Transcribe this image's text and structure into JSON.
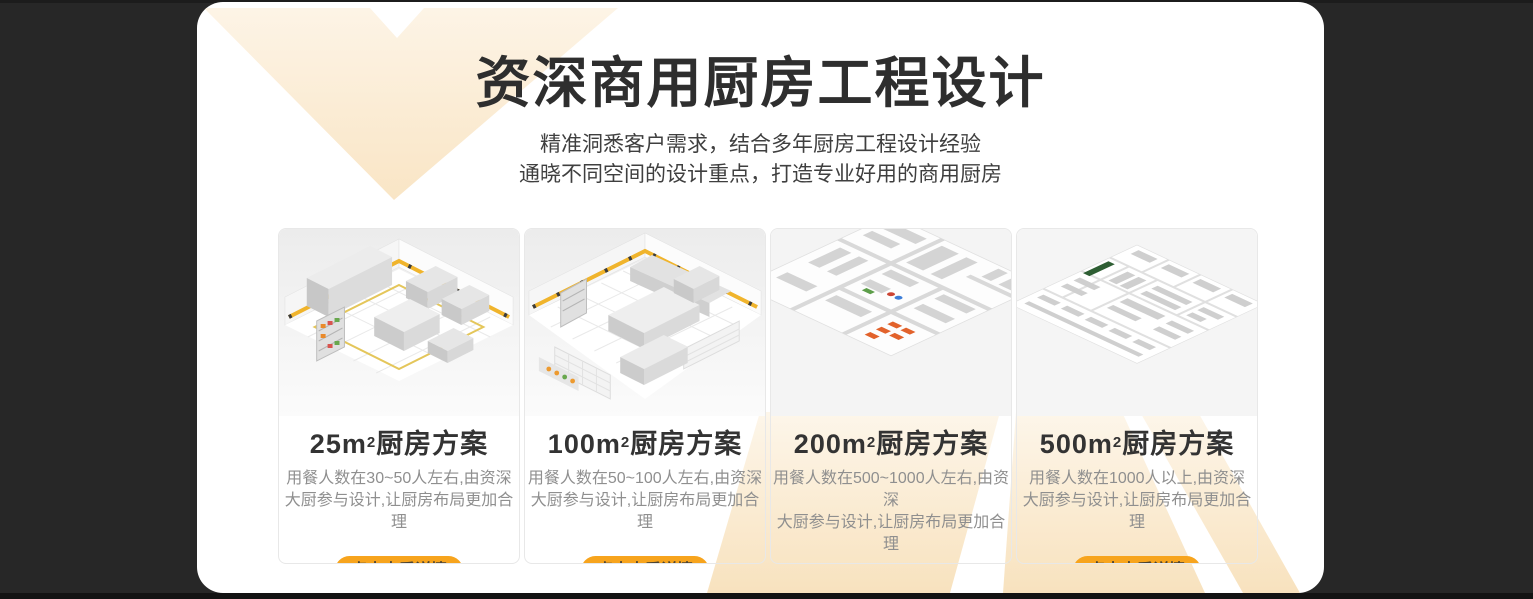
{
  "colors": {
    "background": "#272727",
    "panel": "#FFFFFF",
    "accent_orange": "#F7A41D",
    "decor_cream": "#FBEEDC",
    "title_text": "#2E2E2E",
    "desc_text": "#8F8F8F",
    "button_text": "#4A4335"
  },
  "header": {
    "title": "资深商用厨房工程设计",
    "subtitle_line1": "精准洞悉客户需求，结合多年厨房工程设计经验",
    "subtitle_line2": "通晓不同空间的设计重点，打造专业好用的商用厨房"
  },
  "cards": [
    {
      "area": "25m",
      "sup": "2",
      "title_suffix": "厨房方案",
      "desc_line1": "用餐人数在30~50人左右,由资深",
      "desc_line2": "大厨参与设计,让厨房布局更加合理",
      "button_label": "点击查看详情",
      "image_name": "kitchen-3d-render-25m2"
    },
    {
      "area": "100m",
      "sup": "2",
      "title_suffix": "厨房方案",
      "desc_line1": "用餐人数在50~100人左右,由资深",
      "desc_line2": "大厨参与设计,让厨房布局更加合理",
      "button_label": "点击查看详情",
      "image_name": "kitchen-3d-render-100m2"
    },
    {
      "area": "200m",
      "sup": "2",
      "title_suffix": "厨房方案",
      "desc_line1": "用餐人数在500~1000人左右,由资深",
      "desc_line2": "大厨参与设计,让厨房布局更加合理",
      "button_label": "点击查看详情",
      "image_name": "kitchen-3d-render-200m2"
    },
    {
      "area": "500m",
      "sup": "2",
      "title_suffix": "厨房方案",
      "desc_line1": "用餐人数在1000人以上,由资深",
      "desc_line2": "大厨参与设计,让厨房布局更加合理",
      "button_label": "点击查看详情",
      "image_name": "kitchen-3d-render-500m2"
    }
  ]
}
